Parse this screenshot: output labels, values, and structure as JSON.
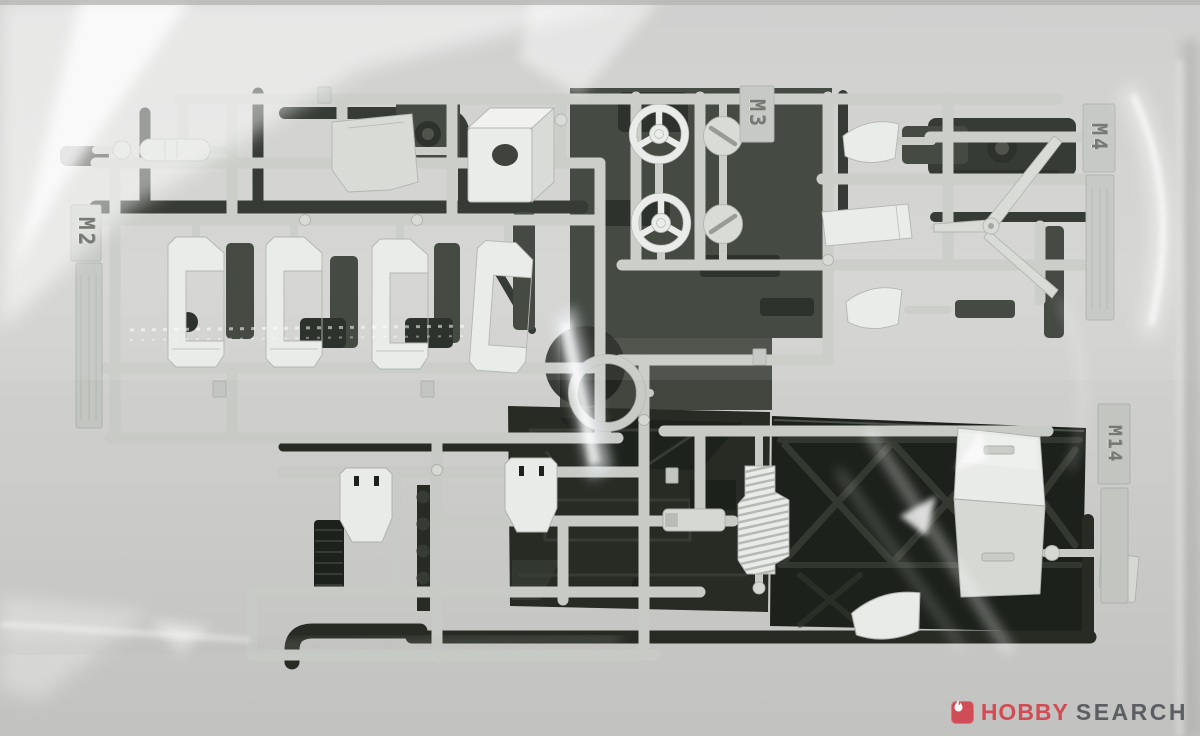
{
  "photo": {
    "runner_tags": [
      {
        "id": "m2",
        "label": "M2"
      },
      {
        "id": "m3",
        "label": "M3"
      },
      {
        "id": "m4",
        "label": "M4"
      },
      {
        "id": "m14",
        "label": "M14"
      }
    ],
    "watermark": {
      "brand_red": "HOBBY",
      "brand_gray": "SEARCH"
    },
    "colors": {
      "bg": "#cdcdcb",
      "bg_bottom": "#c2c2c0",
      "rail": "#c7cac5",
      "rail_dark": "#9aa09a",
      "part_white": "#e9ebe8",
      "part_mid": "#d5d8d3",
      "part_shadow": "#acb1ac",
      "dark": "#272b24",
      "dark2": "#363b33",
      "dark3": "#1d211b",
      "tag_face": "#c2c5c0",
      "tag_text": "#757a74",
      "watermark_red": "#d2434e",
      "watermark_gray": "#53575c"
    }
  }
}
